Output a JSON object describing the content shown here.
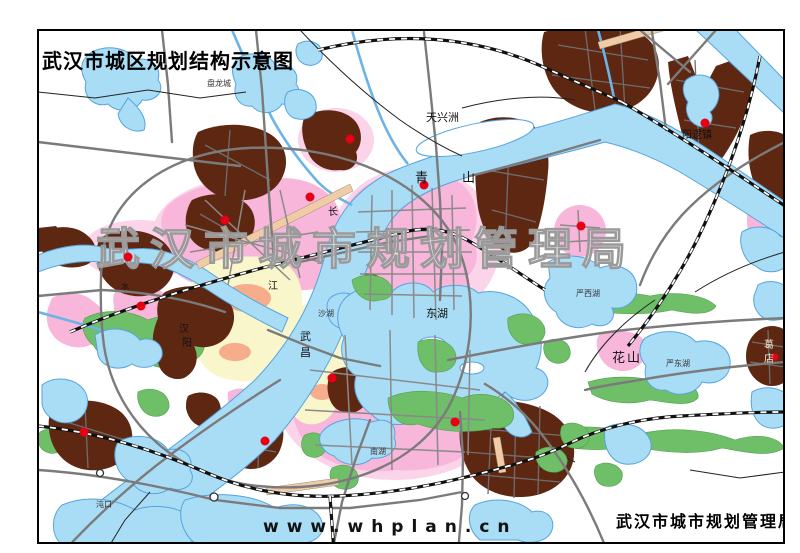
{
  "header": {
    "title": "武汉市城区规划结构示意图"
  },
  "watermark": {
    "text": "武汉市城市规划管理局"
  },
  "footer": {
    "website": "www.whplan.cn",
    "agency": "武汉市城市规划管理局"
  },
  "map": {
    "labels": {
      "panlongcheng": "盘龙城",
      "tianxingzhou": "天兴洲",
      "qingshan": {
        "c1": "青",
        "c2": "山"
      },
      "yangluozhen": "阳逻镇",
      "donghu": "东湖",
      "shahu": "沙湖",
      "nanhu": "南湖",
      "huashan": "花山",
      "yanxihu": "严西湖",
      "yandonghu": "严东湖",
      "gedian": {
        "c1": "葛",
        "c2": "店"
      },
      "zhuankou": "沌口",
      "wuchang": {
        "c1": "武",
        "c2": "昌"
      },
      "hanyang": {
        "c1": "汉",
        "c2": "阳"
      },
      "changjiang": {
        "c1": "长",
        "c2": "江"
      },
      "hanshui": {
        "c1": "水"
      }
    },
    "colors": {
      "water": "#a9dcf5",
      "water_outline": "#55a4df",
      "green_space": "#6fbe68",
      "residential_pink": "#f8b6db",
      "residential_pale": "#fbd4ea",
      "industrial_brown": "#5e2712",
      "old_town_cream": "#faf6cc",
      "mixed_use_salmon": "#f5ad8c",
      "road_gray": "#7b7b7b",
      "town_marker_red": "#e60013"
    }
  }
}
